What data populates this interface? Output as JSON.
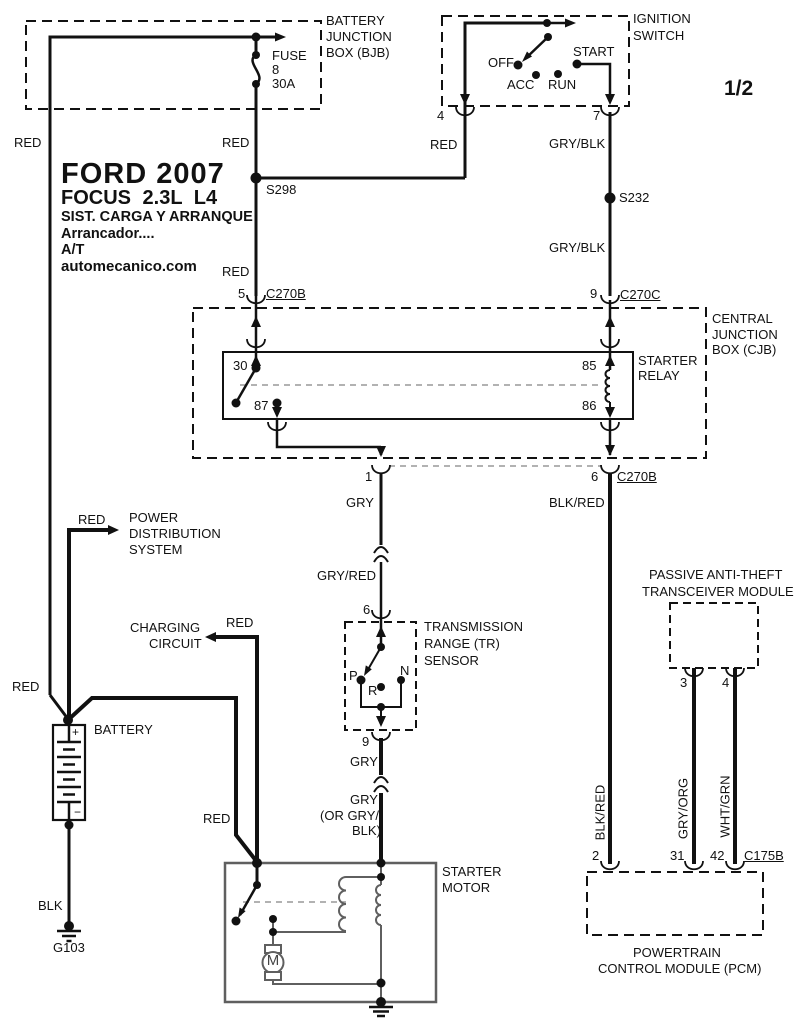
{
  "page": {
    "sheet": "1/2"
  },
  "title_block": {
    "line1": "FORD 2007",
    "line2": "FOCUS 2.3L L4",
    "line3": "SIST. CARGA Y ARRANQUE",
    "line4": "Arrancador....",
    "line5": "A/T",
    "line6": "automecanico.com"
  },
  "battery_junction_box": {
    "label1": "BATTERY",
    "label2": "JUNCTION",
    "label3": "BOX (BJB)",
    "fuse_name": "FUSE",
    "fuse_number": "8",
    "fuse_rating": "30A"
  },
  "ignition_switch": {
    "label1": "IGNITION",
    "label2": "SWITCH",
    "pos_off": "OFF",
    "pos_acc": "ACC",
    "pos_run": "RUN",
    "pos_start": "START",
    "pin_4": "4",
    "pin_7": "7"
  },
  "central_junction_box": {
    "label1": "CENTRAL",
    "label2": "JUNCTION",
    "label3": "BOX (CJB)",
    "pin_5": "5",
    "pin_9": "9",
    "pin_1": "1",
    "pin_6": "6"
  },
  "starter_relay": {
    "label1": "STARTER",
    "label2": "RELAY",
    "pin_30": "30",
    "pin_87": "87",
    "pin_85": "85",
    "pin_86": "86"
  },
  "connectors": {
    "c270b_top": "C270B",
    "c270c": "C270C",
    "c270b_bottom": "C270B",
    "c175b": "C175B"
  },
  "splices": {
    "s298": "S298",
    "s232": "S232"
  },
  "tr_sensor": {
    "label1": "TRANSMISSION",
    "label2": "RANGE (TR)",
    "label3": "SENSOR",
    "pin_6": "6",
    "pin_9": "9",
    "pos_p": "P",
    "pos_r": "R",
    "pos_n": "N"
  },
  "pats_module": {
    "label1": "PASSIVE ANTI-THEFT",
    "label2": "TRANSCEIVER MODULE",
    "pin_3": "3",
    "pin_4": "4"
  },
  "pcm": {
    "label1": "POWERTRAIN",
    "label2": "CONTROL MODULE (PCM)",
    "pin_2": "2",
    "pin_31": "31",
    "pin_42": "42"
  },
  "starter_motor": {
    "label1": "STARTER",
    "label2": "MOTOR",
    "motor_letter": "M"
  },
  "battery": {
    "label": "BATTERY",
    "positive": "+",
    "negative": "−"
  },
  "ground": {
    "g103": "G103",
    "wire": "BLK"
  },
  "power_distribution": {
    "label1": "POWER",
    "label2": "DISTRIBUTION",
    "label3": "SYSTEM",
    "wire": "RED"
  },
  "charging_circuit": {
    "label1": "CHARGING",
    "label2": "CIRCUIT",
    "wire": "RED"
  },
  "wires": {
    "left_feed_top": "RED",
    "left_feed_bottom": "RED",
    "fuse_in": "RED",
    "fuse_out": "RED",
    "ign_feed": "RED",
    "ign_start_out_1": "GRY/BLK",
    "ign_start_out_2": "GRY/BLK",
    "relay_out_1": "GRY",
    "relay_out_2": "GRY/RED",
    "tr_out_1": "GRY",
    "tr_out_2a": "GRY",
    "tr_out_2b": "(OR GRY/",
    "tr_out_2c": "BLK)",
    "starter_feed": "RED",
    "pcm_feed_h": "BLK/RED",
    "pcm_feed_v": "BLK/RED",
    "pats_out_3": "GRY/ORG",
    "pats_out_4": "WHT/GRN"
  }
}
